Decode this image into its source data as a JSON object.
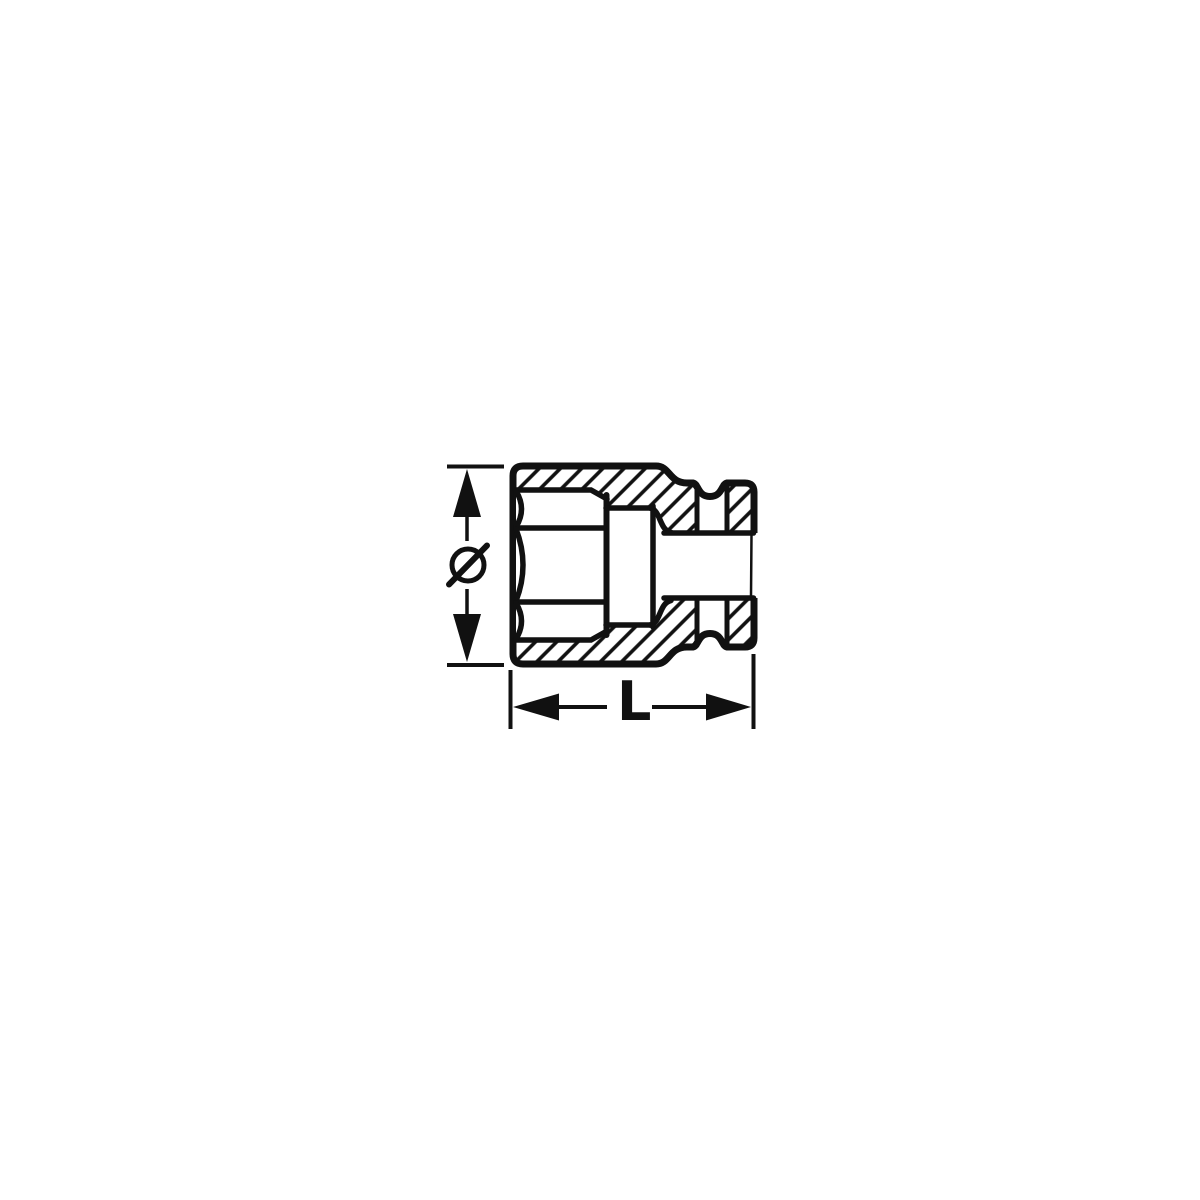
{
  "diagram": {
    "type": "technical-drawing",
    "subject": "impact socket cross-section with dimension lines",
    "background_color": "#ffffff",
    "line_color": "#111111",
    "hatch": {
      "style": "diagonal",
      "direction": "bottom-left-to-top-right"
    },
    "dimensions": {
      "diameter": {
        "symbol": "Ø",
        "orientation": "vertical",
        "position": "left"
      },
      "length": {
        "label": "L",
        "orientation": "horizontal",
        "position": "bottom"
      }
    },
    "features": [
      "hexagon-recess-mouth",
      "stepped-inner-bore",
      "square-drive-hole",
      "retaining-pin-channel",
      "o-ring-groove"
    ]
  }
}
